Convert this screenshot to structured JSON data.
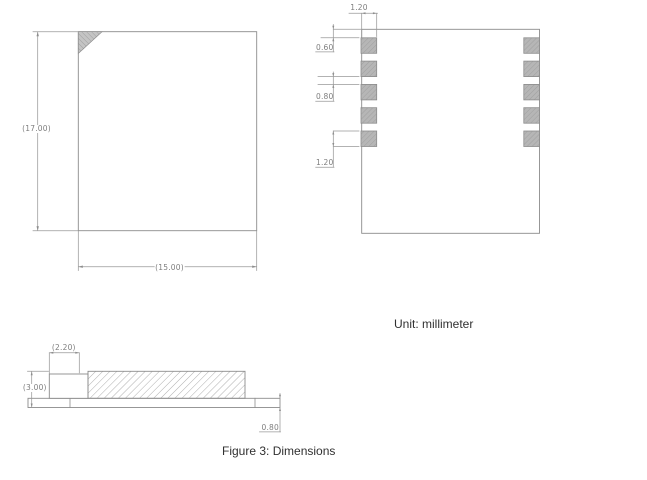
{
  "figure": {
    "unit_note": "Unit: millimeter",
    "caption": "Figure 3: Dimensions"
  },
  "top_view": {
    "height_dim": "(17.00)",
    "width_dim": "(15.00)"
  },
  "pad_view": {
    "pad_width_dim": "1.20",
    "top_edge_offset_dim": "0.60",
    "pad_gap_dim": "0.80",
    "pad_height_dim": "1.20",
    "pads_per_side": 5
  },
  "side_view": {
    "shield_offset_dim": "(2.20)",
    "overall_height_dim": "(3.00)",
    "base_thickness_dim": "0.80"
  },
  "colors": {
    "drawing_line": "#8c8c8c",
    "dim_line": "#999999",
    "dim_text": "#7e7e7e",
    "pad_fill": "#b6b6b6",
    "body_text": "#303030"
  }
}
